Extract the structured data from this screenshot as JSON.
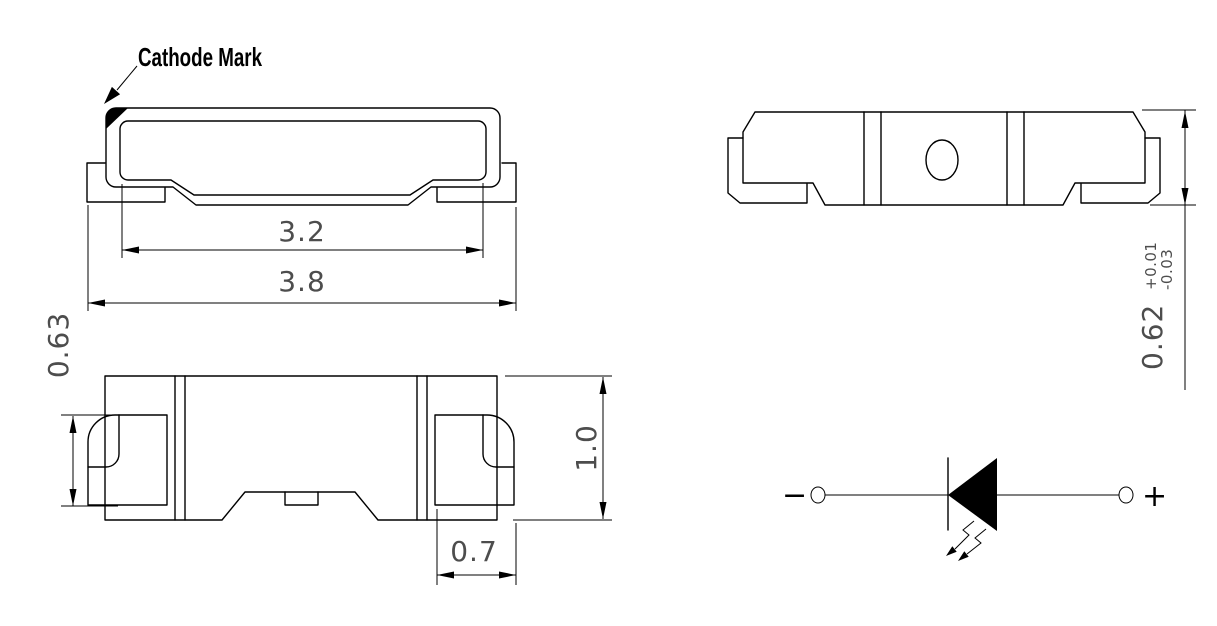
{
  "drawing": {
    "callout_label": "Cathode Mark",
    "dim_inner_width": "3.2",
    "dim_outer_width": "3.8",
    "dim_lead_height": "0.63",
    "dim_body_height": "1.0",
    "dim_lead_width": "0.7",
    "dim_back_height": "0.62",
    "dim_back_tol_plus": "+0.01",
    "dim_back_tol_minus": "-0.03",
    "schematic_negative": "−",
    "schematic_positive": "+",
    "colors": {
      "line": "#000000",
      "dim_text": "#4d4d4d",
      "background": "#ffffff"
    }
  }
}
